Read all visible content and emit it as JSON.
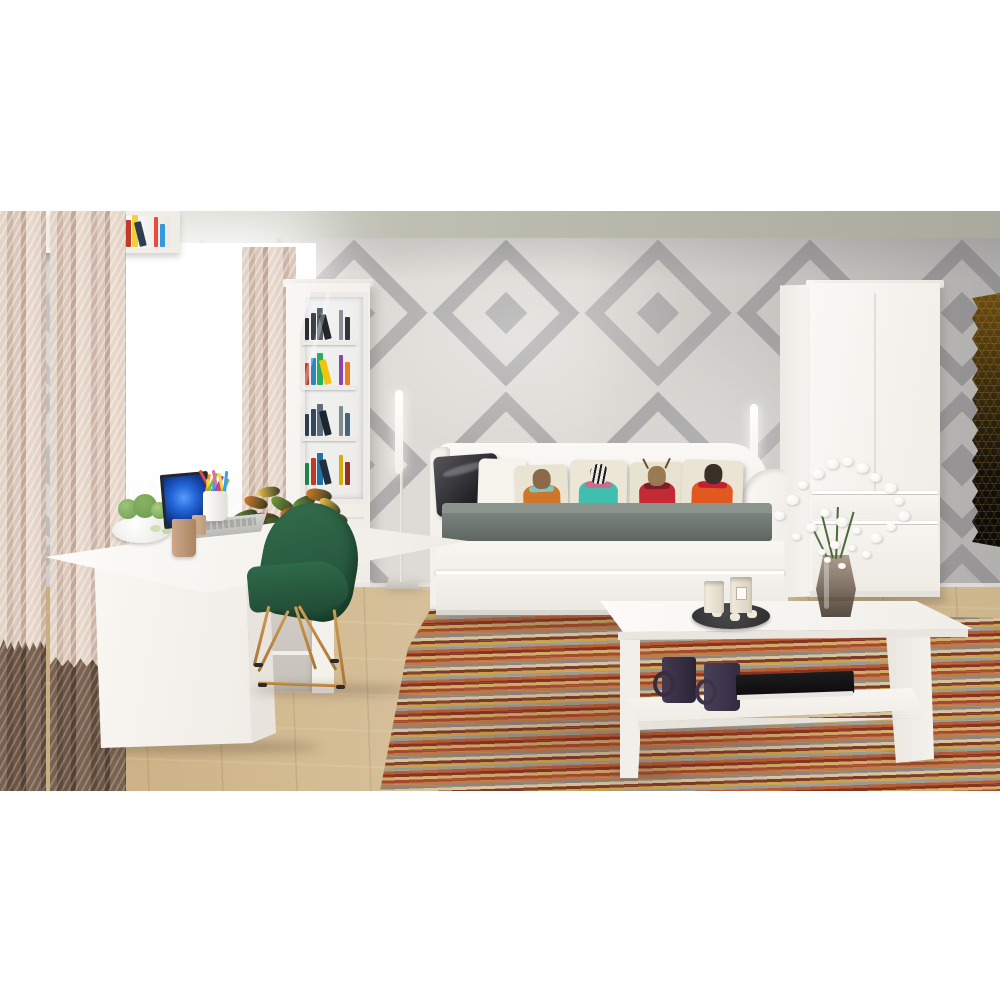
{
  "meta": {
    "kind": "interior-photo",
    "description": "Living room with white furniture set: corner desk, daybed with animal-print pillows, glass-door bookcase, wardrobe, coffee table, geometric diamond wallpaper, striped rug"
  },
  "palette": {
    "ceiling": "#b8b8ac",
    "wall_light": "#dedbd6",
    "wall_diamond_gray": "#a8a5a6",
    "floor_wood": "#d3bb92",
    "furniture_white": "#f7f5f1",
    "curtain_beige": "#d9c5b7",
    "curtain_dark": "#64503f",
    "mattress_gray": "#68736d",
    "chair_green": "#2b5f45",
    "chair_legs_gold": "#bb8a48",
    "laptop_screen_blue": "#2266d8",
    "hex_panel": "#3a2b0e",
    "rug_base": "#b06038"
  },
  "wallpaper": {
    "tile": 152,
    "cols": 8,
    "rows": 3,
    "origin_x": -26,
    "origin_y": 13,
    "diamond": "#a8a5a6",
    "mid": "#dcd9d4",
    "core": "#a8a5a6",
    "sizes": [
      104,
      76,
      30
    ]
  },
  "rug": {
    "stripes": [
      "#a34a2c",
      "#c07a48",
      "#8f857c",
      "#d8c49c",
      "#7e3a28",
      "#caa24e",
      "#9a9a94",
      "#b85c34",
      "#86341f",
      "#d2aa6a"
    ]
  },
  "bookcase": {
    "shelves": [
      [
        "#2a2d33",
        "#3c4048",
        "#596068",
        "#23262b",
        "#8a8f97",
        "#31353c"
      ],
      [
        "#c0392b",
        "#2e86c1",
        "#27ae60",
        "#f1c40f",
        "#8e44ad",
        "#e67e22",
        "#b03a2e"
      ],
      [
        "#2c3e50",
        "#34495e",
        "#5d6d7e",
        "#1b2631",
        "#7f8c8d",
        "#46637f"
      ],
      [
        "#1e8449",
        "#c0392b",
        "#2471a3",
        "#212f3c",
        "#d4ac0d",
        "#943126",
        "#117a65"
      ]
    ]
  },
  "wall_shelf": {
    "compartments": [
      {
        "type": "board"
      },
      {
        "type": "books",
        "colors": [
          "#c0392b",
          "#e67e22",
          "#f1c40f",
          "#27ae60",
          "#2e86c1",
          "#8e44ad",
          "#d35400",
          "#16a085"
        ]
      },
      {
        "type": "books",
        "colors": [
          "#27ae60",
          "#c0392b",
          "#f4d03f",
          "#2c3e50",
          "#e74c3c",
          "#3498db",
          "#229954",
          "#17202a"
        ]
      }
    ]
  },
  "pillows": [
    {
      "kind": "leather",
      "base": "#3a3a40"
    },
    {
      "kind": "plain",
      "base": "#f6f3ed"
    },
    {
      "kind": "print",
      "base": "#e9e3d1",
      "head": "#8a6a4a",
      "body": "#d0762a",
      "accent": "#7ac8c0",
      "zebra": false,
      "antlers": false
    },
    {
      "kind": "print",
      "base": "#ece6d6",
      "head": "#ece9e2",
      "body": "#3fbfae",
      "accent": "#d06a8a",
      "zebra": true,
      "antlers": false
    },
    {
      "kind": "print",
      "base": "#e8e2d0",
      "head": "#9a7a52",
      "body": "#c22a35",
      "accent": "#7e1f28",
      "zebra": false,
      "antlers": true
    },
    {
      "kind": "print",
      "base": "#eae4d4",
      "head": "#3a2f28",
      "body": "#e05a20",
      "accent": "#c02030",
      "zebra": false,
      "antlers": false
    }
  ],
  "pencils": [
    "#e04a3a",
    "#f59b22",
    "#ffd23f",
    "#7ac043",
    "#3aa0e8",
    "#e86aa0",
    "#8a52c0",
    "#e04a3a",
    "#ffd23f",
    "#7ac043",
    "#3aa0e8"
  ],
  "croton": {
    "colors": [
      "#3f6a2a",
      "#6b9a3a",
      "#d07a2a",
      "#e8c04a",
      "#8a4420"
    ],
    "leaves": [
      [
        232,
        300,
        26,
        12,
        -20,
        1
      ],
      [
        244,
        286,
        24,
        11,
        15,
        2
      ],
      [
        258,
        276,
        22,
        10,
        -8,
        3
      ],
      [
        270,
        288,
        26,
        12,
        30,
        1
      ],
      [
        252,
        302,
        28,
        12,
        5,
        4
      ],
      [
        238,
        314,
        24,
        10,
        -30,
        0
      ],
      [
        266,
        308,
        26,
        11,
        18,
        0
      ],
      [
        280,
        296,
        22,
        10,
        -15,
        2
      ],
      [
        292,
        286,
        24,
        12,
        -25,
        1
      ],
      [
        306,
        278,
        26,
        12,
        10,
        2
      ],
      [
        318,
        290,
        24,
        11,
        35,
        3
      ],
      [
        296,
        304,
        28,
        13,
        0,
        0
      ],
      [
        312,
        312,
        26,
        12,
        -18,
        4
      ],
      [
        326,
        302,
        22,
        10,
        20,
        1
      ],
      [
        300,
        330,
        26,
        12,
        -35,
        0
      ],
      [
        318,
        340,
        24,
        11,
        12,
        2
      ],
      [
        306,
        356,
        26,
        12,
        -10,
        3
      ],
      [
        320,
        370,
        24,
        11,
        25,
        0
      ],
      [
        298,
        378,
        22,
        10,
        -28,
        4
      ],
      [
        312,
        388,
        20,
        9,
        8,
        1
      ]
    ]
  },
  "flowers": {
    "petal": "#f7f5ef",
    "stem": "#4a6a3a",
    "positions": [
      [
        774,
        300,
        11
      ],
      [
        786,
        284,
        13
      ],
      [
        798,
        270,
        10
      ],
      [
        812,
        258,
        12
      ],
      [
        826,
        248,
        13
      ],
      [
        842,
        246,
        11
      ],
      [
        856,
        252,
        13
      ],
      [
        870,
        262,
        11
      ],
      [
        884,
        272,
        13
      ],
      [
        894,
        286,
        10
      ],
      [
        898,
        300,
        12
      ],
      [
        886,
        312,
        10
      ],
      [
        870,
        322,
        12
      ],
      [
        852,
        316,
        9
      ],
      [
        836,
        306,
        12
      ],
      [
        820,
        298,
        10
      ],
      [
        806,
        312,
        11
      ],
      [
        792,
        322,
        9
      ],
      [
        830,
        330,
        10
      ],
      [
        848,
        334,
        8
      ],
      [
        862,
        340,
        9
      ],
      [
        818,
        338,
        8
      ],
      [
        838,
        352,
        8
      ],
      [
        824,
        346,
        7
      ]
    ]
  },
  "cacti": [
    "#9cc47a",
    "#86b363",
    "#a8cc82"
  ],
  "objects": [
    {
      "label": "striped curtains"
    },
    {
      "label": "bright window with sheer"
    },
    {
      "label": "corner desk"
    },
    {
      "label": "laptop"
    },
    {
      "label": "pencil cup"
    },
    {
      "label": "succulent bowl"
    },
    {
      "label": "mug"
    },
    {
      "label": "green wire chair"
    },
    {
      "label": "croton plant"
    },
    {
      "label": "glass-door bookcase"
    },
    {
      "label": "wall cube shelf with books"
    },
    {
      "label": "floor lamp left"
    },
    {
      "label": "floor lamp right"
    },
    {
      "label": "white daybed with drawer"
    },
    {
      "label": "animal print pillows"
    },
    {
      "label": "two-door wardrobe"
    },
    {
      "label": "hexagon wall decor"
    },
    {
      "label": "coffee table"
    },
    {
      "label": "candle tray"
    },
    {
      "label": "two dark mugs"
    },
    {
      "label": "black book"
    },
    {
      "label": "vase with white flowers"
    },
    {
      "label": "striped rug"
    },
    {
      "label": "wood floor"
    }
  ]
}
